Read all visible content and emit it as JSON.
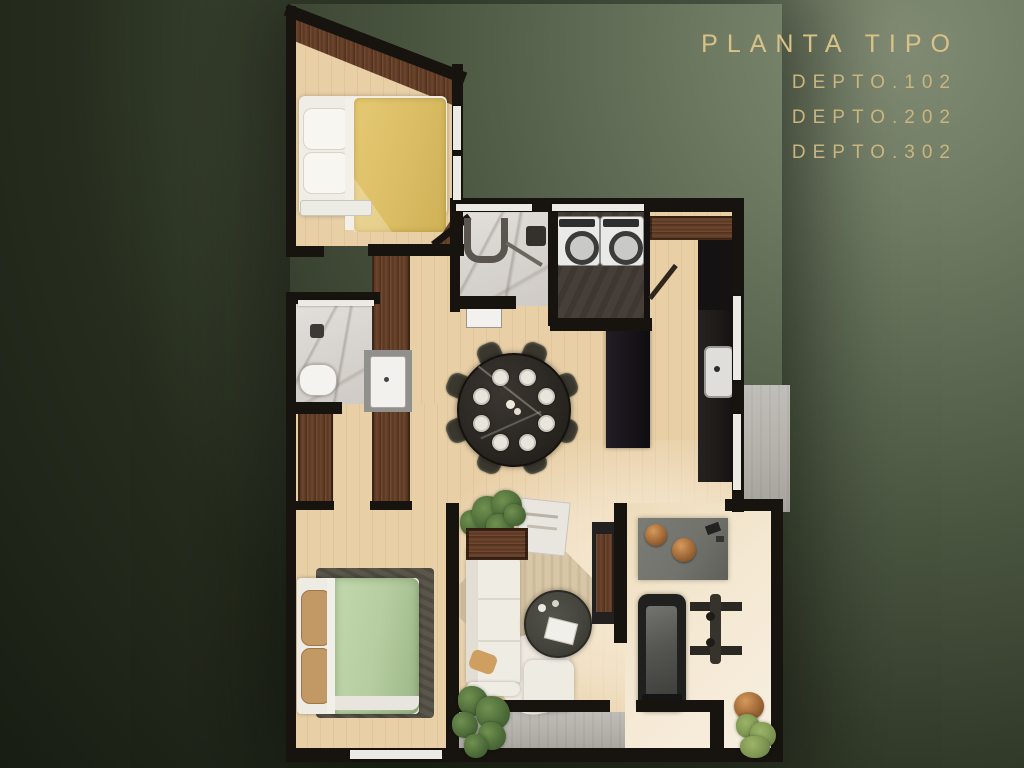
{
  "title_block": {
    "title": "PLANTA TIPO",
    "units": [
      "DEPTO.102",
      "DEPTO.202",
      "DEPTO.302"
    ]
  },
  "colors": {
    "bg_dark": "#181d13",
    "bg_mid": "#3c4632",
    "bg_light": "#828c74",
    "gold": "#d9c288",
    "gold_soft": "#c9b67e",
    "wall": "#17130e",
    "wood_floor": "#e8cfa6",
    "wood_floor_light": "#f5ead6",
    "wood_dark": "#6b4530",
    "wood_darker": "#4f3019",
    "marble": "#d8d4d0",
    "marble_vein": "#a89f97",
    "concrete": "#b5b2ac",
    "laundry_floor": "#453f38",
    "bed_yellow": "#dcbf67",
    "bed_green": "#b5cda0",
    "pillow_tan": "#c29864",
    "sofa_white": "#efece4",
    "rug_beige": "#d8c7a7",
    "rug_dark": "#5a564b",
    "table_black": "#2b2722",
    "chair_dark": "#3a382e",
    "desk_gray": "#72736c",
    "bronze": "#a9703c",
    "plant_green": "#55743f",
    "appliance_white": "#e9e9e7",
    "counter_black": "#1c1917",
    "glass_white": "#eceae5"
  }
}
